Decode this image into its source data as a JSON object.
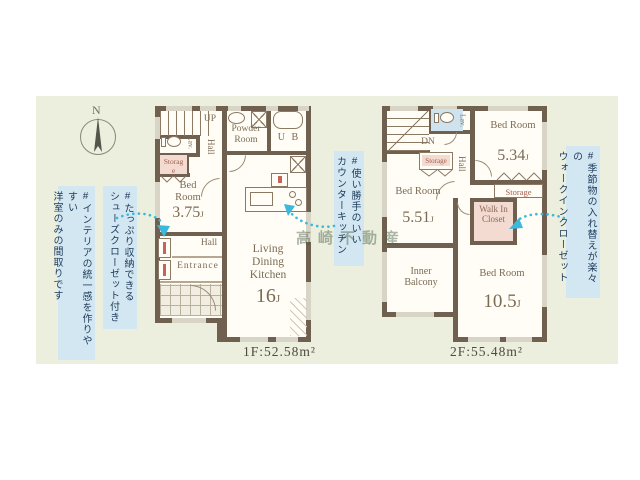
{
  "compass": {
    "north_label": "N"
  },
  "hashtags": {
    "interior": {
      "line1": "#インテリアの統一感を作りやすい",
      "line2": "洋室のみの間取りです"
    },
    "shoes": {
      "line1": "#たっぷり収納できる",
      "line2": "シューズクローゼット付き"
    },
    "counter_kitchen": {
      "line1": "#使い勝手のいい",
      "line2": "カウンターキッチン"
    },
    "walk_in_closet": {
      "line1": "#季節物の入れ替えが楽々の",
      "line2": "ウォークインクローゼット"
    }
  },
  "floor1": {
    "area_label": "1F:52.58m²",
    "stairs_label": "UP",
    "lavatory_label": "Lav.",
    "hall_upper_label": "Hall",
    "powder_room_label": "Powder Room",
    "unit_bath_label": "U B",
    "storage_label": "Storage",
    "bedroom": {
      "name": "Bed Room",
      "size": "3.75",
      "unit": "J"
    },
    "ldk": {
      "line1": "Living",
      "line2": "Dining",
      "line3": "Kitchen",
      "size": "16",
      "unit": "J"
    },
    "hall_lower_label": "Hall",
    "entrance_label": "Entrance"
  },
  "floor2": {
    "area_label": "2F:55.48m²",
    "stairs_label": "DN",
    "lavatory_label": "Lav.",
    "hall_label": "Hall",
    "storage_small_label": "Storage",
    "storage_label": "Storage",
    "bedroom_534": {
      "name": "Bed Room",
      "size": "5.34",
      "unit": "J"
    },
    "bedroom_551": {
      "name": "Bed Room",
      "size": "5.51",
      "unit": "J"
    },
    "walk_in_closet_label": "Walk In Closet",
    "inner_balcony_label": "Inner Balcony",
    "bedroom_105": {
      "name": "Bed Room",
      "size": "10.5",
      "unit": "J"
    }
  },
  "watermark": "高崎不動産",
  "colors": {
    "wall": "#6f6050",
    "background_panel": "#ecefdd",
    "annotation_bg": "#d3e7f2",
    "annotation_text": "#1d3b5a",
    "arrow": "#3cb8dd",
    "storage_fill": "#f3dbd2",
    "fixture_blue": "#cfe3ee",
    "room_text": "#7b6b55"
  }
}
